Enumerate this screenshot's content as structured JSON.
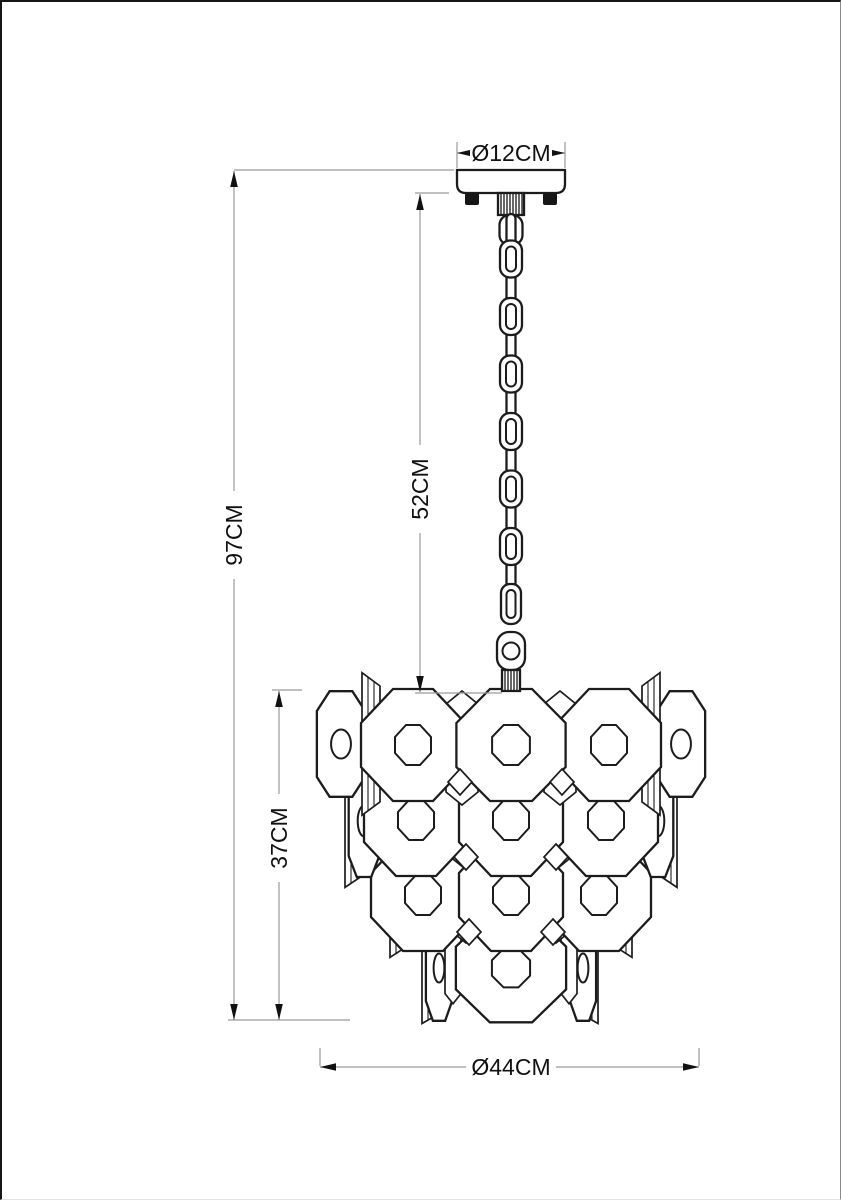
{
  "drawing": {
    "labels": {
      "canopy_diameter": "Ø12CM",
      "chain_length": "52CM",
      "overall_height": "97CM",
      "shade_height": "37CM",
      "shade_diameter": "Ø44CM"
    },
    "colors": {
      "outline": "#1c1c1c",
      "dimension_line": "#9a9a9a",
      "label_text": "#111111",
      "background": "#ffffff"
    }
  }
}
